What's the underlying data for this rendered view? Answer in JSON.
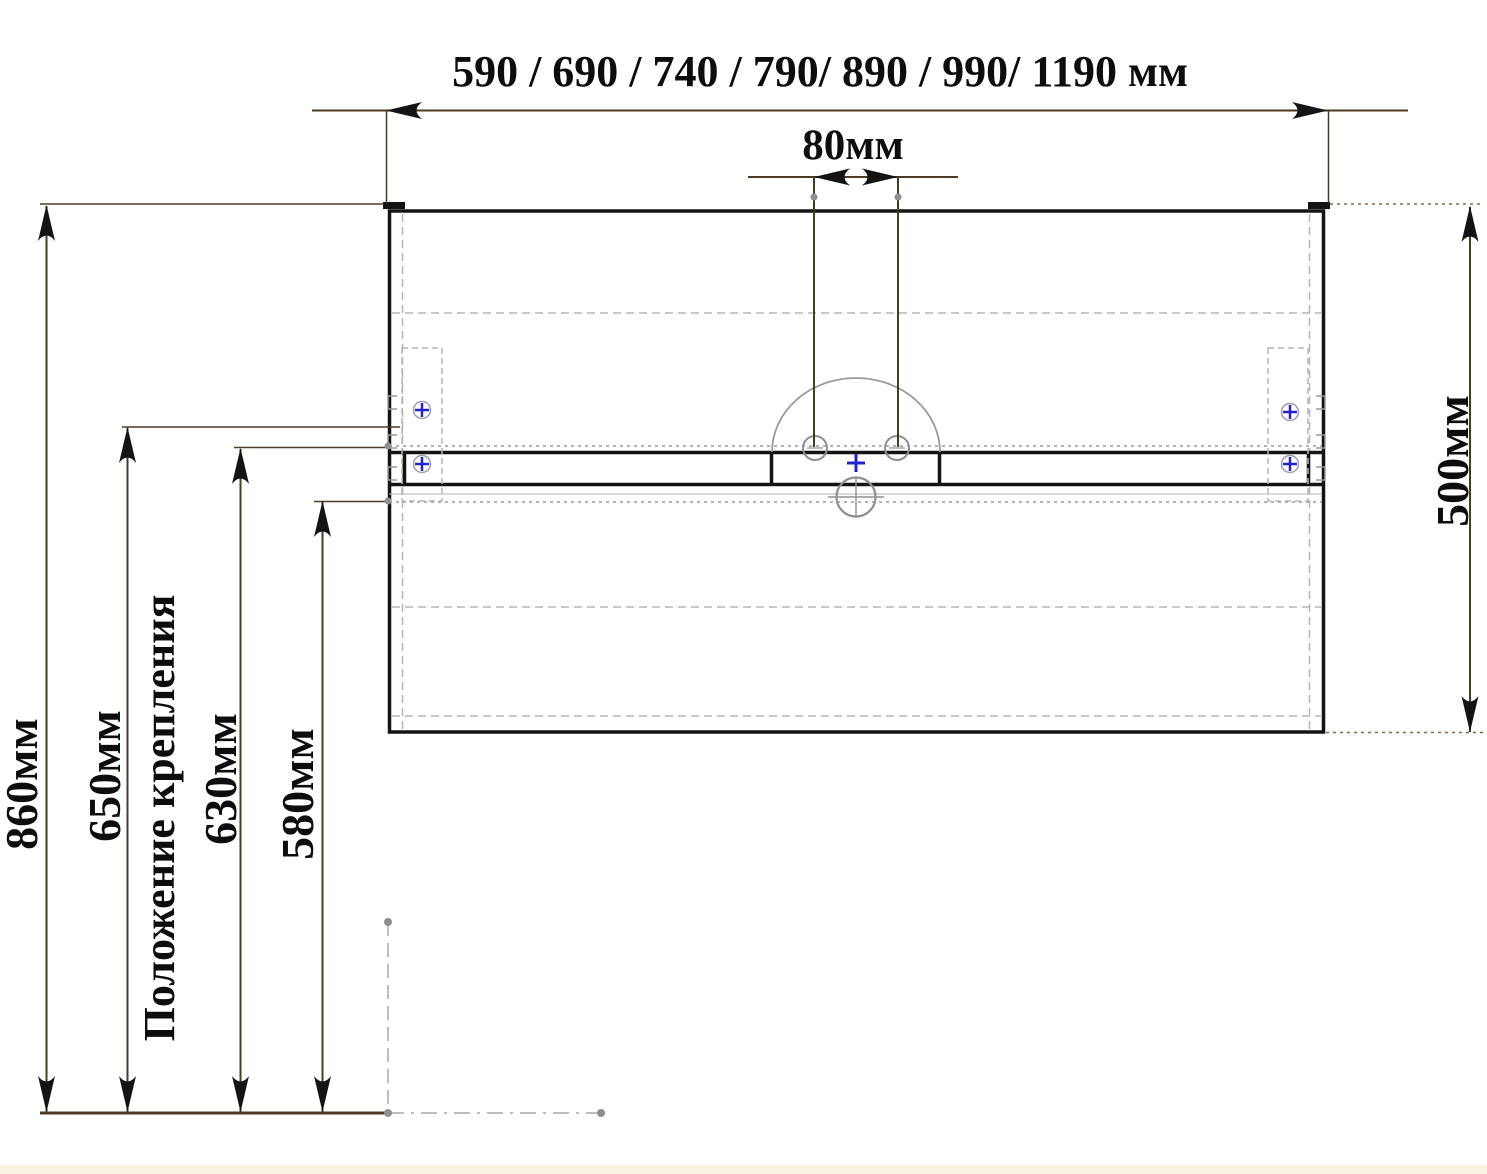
{
  "diagram": {
    "kind": "vanity-cabinet mounting drawing (front view)",
    "labels": {
      "width_options": "590 / 690 / 740 / 790/ 890 / 990/ 1190 мм",
      "faucet_hole_spacing": "80мм",
      "cabinet_height": "500мм",
      "floor_to_top": "860мм",
      "mount_upper": "650мм",
      "mounting_position": "Положение крепления",
      "mount_lower": "630мм",
      "floor_to_rail_bottom": "580мм"
    },
    "measurements_mm": {
      "available_widths": [
        590,
        690,
        740,
        790,
        890,
        990,
        1190
      ],
      "faucet_hole_spacing": 80,
      "cabinet_height": 500,
      "floor_to_cabinet_top": 860,
      "mounting_height_upper": 650,
      "mounting_height_lower": 630,
      "floor_to_rail_bottom": 580
    },
    "colors": {
      "dimension_line": "#4c3a22",
      "drawing_line": "#141414",
      "hidden_line": "#b5b5b5",
      "reference_line": "#a8a8a8",
      "marker_blue": "#2222cc",
      "circle_gray": "#8f8f8f",
      "footer_strip": "#fbf3e2"
    }
  }
}
